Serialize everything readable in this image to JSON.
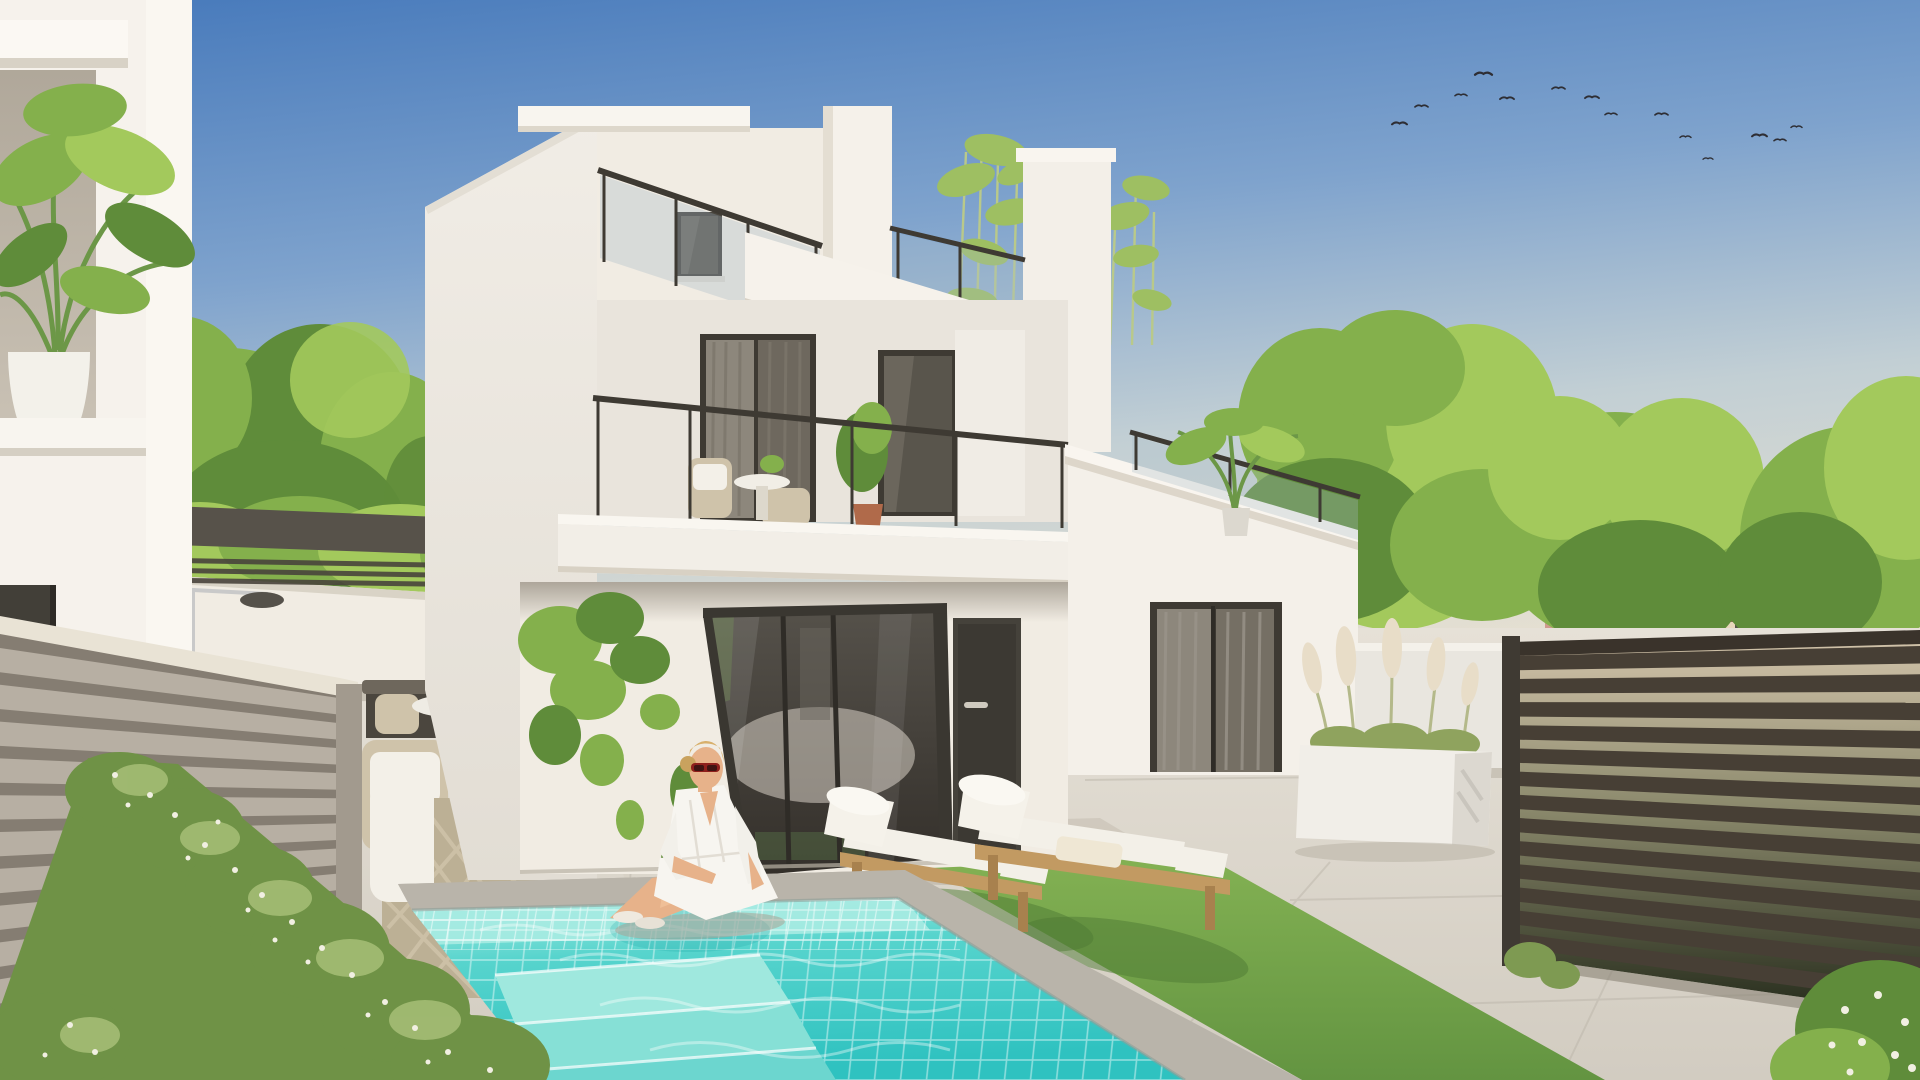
{
  "scene": {
    "type": "architectural exterior rendering",
    "subject": "modern white two-storey villa with roof terrace, swimming pool, sun loungers and garden patio",
    "sky": "clear blue sky, flock of birds upper right",
    "figures": "woman in white shirt dress with red sunglasses seated at pool corner",
    "no_visible_text": true
  },
  "palette": {
    "sky_top": "#4679bb",
    "sky_mid": "#7fa3cd",
    "sky_low": "#c2cfd4",
    "sky_horizon": "#e8e1d1",
    "wall_lit": "#f6f2ec",
    "wall_warm": "#f1ece3",
    "wall_shade": "#e9e4dc",
    "wall_deep": "#d9d3c8",
    "frame_dark": "#3e3a33",
    "glass_top": "#55514a",
    "glass_bottom": "#332f2a",
    "curtain": "#8d877c",
    "curtain_dark": "#6e685e",
    "pergola": "#57524a",
    "left_fence_slat": "#b7afa3",
    "left_fence_gap": "#857d72",
    "left_fence_cap": "#e9e3d5",
    "right_fence_slat": "#473f35",
    "right_fence_gap_light": "#d3c4ab",
    "right_fence_gap_dark": "#252b1b",
    "patio_far": "#e6e1d7",
    "patio_near": "#d2ccc1",
    "grout": "#b9b3a7",
    "pool_coping": "#b9b4aa",
    "pool_shallow": "#a7ebe2",
    "pool_mid": "#57d4cd",
    "pool_deep": "#2fc2c0",
    "pool_step": "#9fe8de",
    "grass_light": "#83b153",
    "grass_dark": "#639441",
    "grass_shadow": "#4e7a33",
    "hedge": "#6f9246",
    "hedge_light": "#a4bd74",
    "hedge_flower": "#f1efe2",
    "foliage_bright": "#a3c95c",
    "foliage_mid": "#84b04c",
    "foliage_dark": "#5f8c3a",
    "bamboo": "#9ebf62",
    "lounger_wood": "#c29a62",
    "cushion_white": "#f3f0e8",
    "rope_beige": "#cfc3aa",
    "bench_dark": "#4b463e",
    "terracotta": "#b06a4a",
    "building_cream": "#e7d6bb",
    "building_roof": "#a96e49",
    "building_pink": "#cf9a8e",
    "skin": "#e7b28a",
    "hair_blonde": "#d8b06c",
    "sunglasses_red": "#8e1f1c",
    "chrome": "#c9c9c9",
    "bird": "#2e2e34"
  },
  "birds": [
    {
      "x": 1392,
      "y": 121,
      "s": 15,
      "f": 0
    },
    {
      "x": 1428,
      "y": 104,
      "s": 13,
      "f": 1
    },
    {
      "x": 1455,
      "y": 93,
      "s": 12,
      "f": 0
    },
    {
      "x": 1475,
      "y": 71,
      "s": 17,
      "f": 0
    },
    {
      "x": 1514,
      "y": 96,
      "s": 14,
      "f": 1
    },
    {
      "x": 1552,
      "y": 86,
      "s": 13,
      "f": 0
    },
    {
      "x": 1585,
      "y": 95,
      "s": 14,
      "f": 0
    },
    {
      "x": 1617,
      "y": 112,
      "s": 12,
      "f": 1
    },
    {
      "x": 1655,
      "y": 112,
      "s": 13,
      "f": 0
    },
    {
      "x": 1680,
      "y": 135,
      "s": 11,
      "f": 0
    },
    {
      "x": 1713,
      "y": 157,
      "s": 10,
      "f": 1
    },
    {
      "x": 1752,
      "y": 133,
      "s": 15,
      "f": 0
    },
    {
      "x": 1774,
      "y": 138,
      "s": 12,
      "f": 0
    },
    {
      "x": 1802,
      "y": 125,
      "s": 11,
      "f": 1
    }
  ],
  "right_fence": {
    "slat_count": 13
  },
  "left_fence": {
    "slat_count": 10
  }
}
